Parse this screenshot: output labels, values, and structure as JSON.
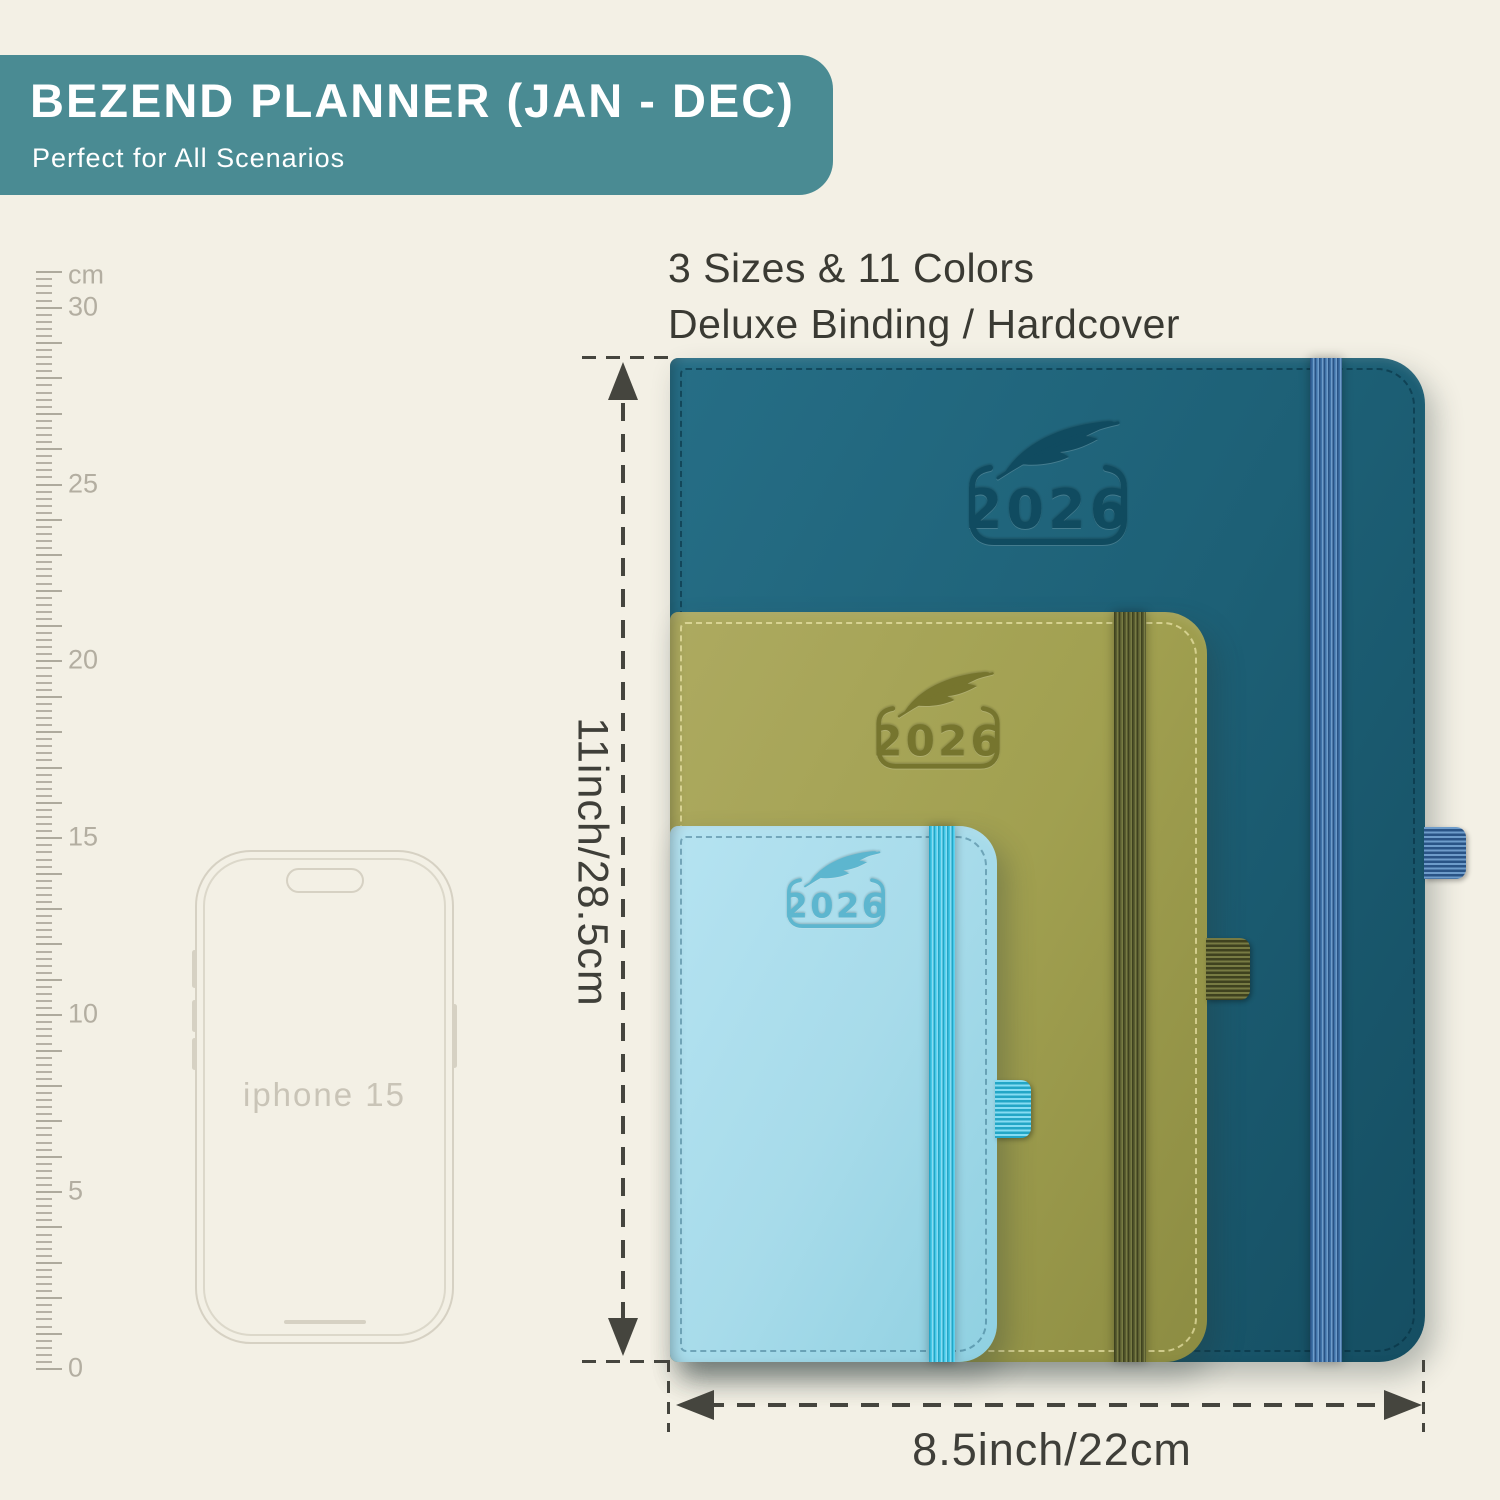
{
  "banner": {
    "title": "BEZEND PLANNER (JAN - DEC)",
    "subtitle": "Perfect for All Scenarios",
    "bg_color": "#4a8b93"
  },
  "features": {
    "line1": "3 Sizes & 11 Colors",
    "line2": "Deluxe Binding / Hardcover"
  },
  "ruler": {
    "unit": "cm",
    "labels": [
      "30",
      "25",
      "20",
      "15",
      "10",
      "5",
      "0"
    ],
    "label_values": [
      30,
      25,
      20,
      15,
      10,
      5,
      0
    ],
    "max_cm": 31,
    "minor_per_cm": 5,
    "px_per_cm": 35.38,
    "zero_y": 1368,
    "tick_color": "#b6b1a5"
  },
  "phone": {
    "label": "iphone 15"
  },
  "planners": [
    {
      "id": "large",
      "year": "2026",
      "logo_icon": "feather",
      "cover_light": "#266e86",
      "cover": "#1d6076",
      "cover_dark": "#154e62",
      "band": "#3f72a8",
      "band_light": "#6e9cca",
      "band_dark": "#2a5486",
      "stitch": "#062c3c8c",
      "emboss": "#0f4a5e"
    },
    {
      "id": "medium",
      "year": "2026",
      "logo_icon": "feather",
      "cover_light": "#adaa60",
      "cover": "#a1a050",
      "cover_dark": "#8c8c42",
      "band": "#5a5d31",
      "band_light": "#777b43",
      "band_dark": "#3f421f",
      "stitch": "#ece5aab3",
      "emboss": "#73722c"
    },
    {
      "id": "small",
      "year": "2026",
      "logo_icon": "feather",
      "cover_light": "#b5e3f1",
      "cover": "#a7dbea",
      "cover_dark": "#8fd0e1",
      "band": "#43c8e8",
      "band_light": "#85dcf3",
      "band_dark": "#23a6c6",
      "stitch": "#1a546e66",
      "emboss": "#58b4cd"
    }
  ],
  "dimensions": {
    "height_label": "11inch/28.5cm",
    "width_label": "8.5inch/22cm"
  }
}
